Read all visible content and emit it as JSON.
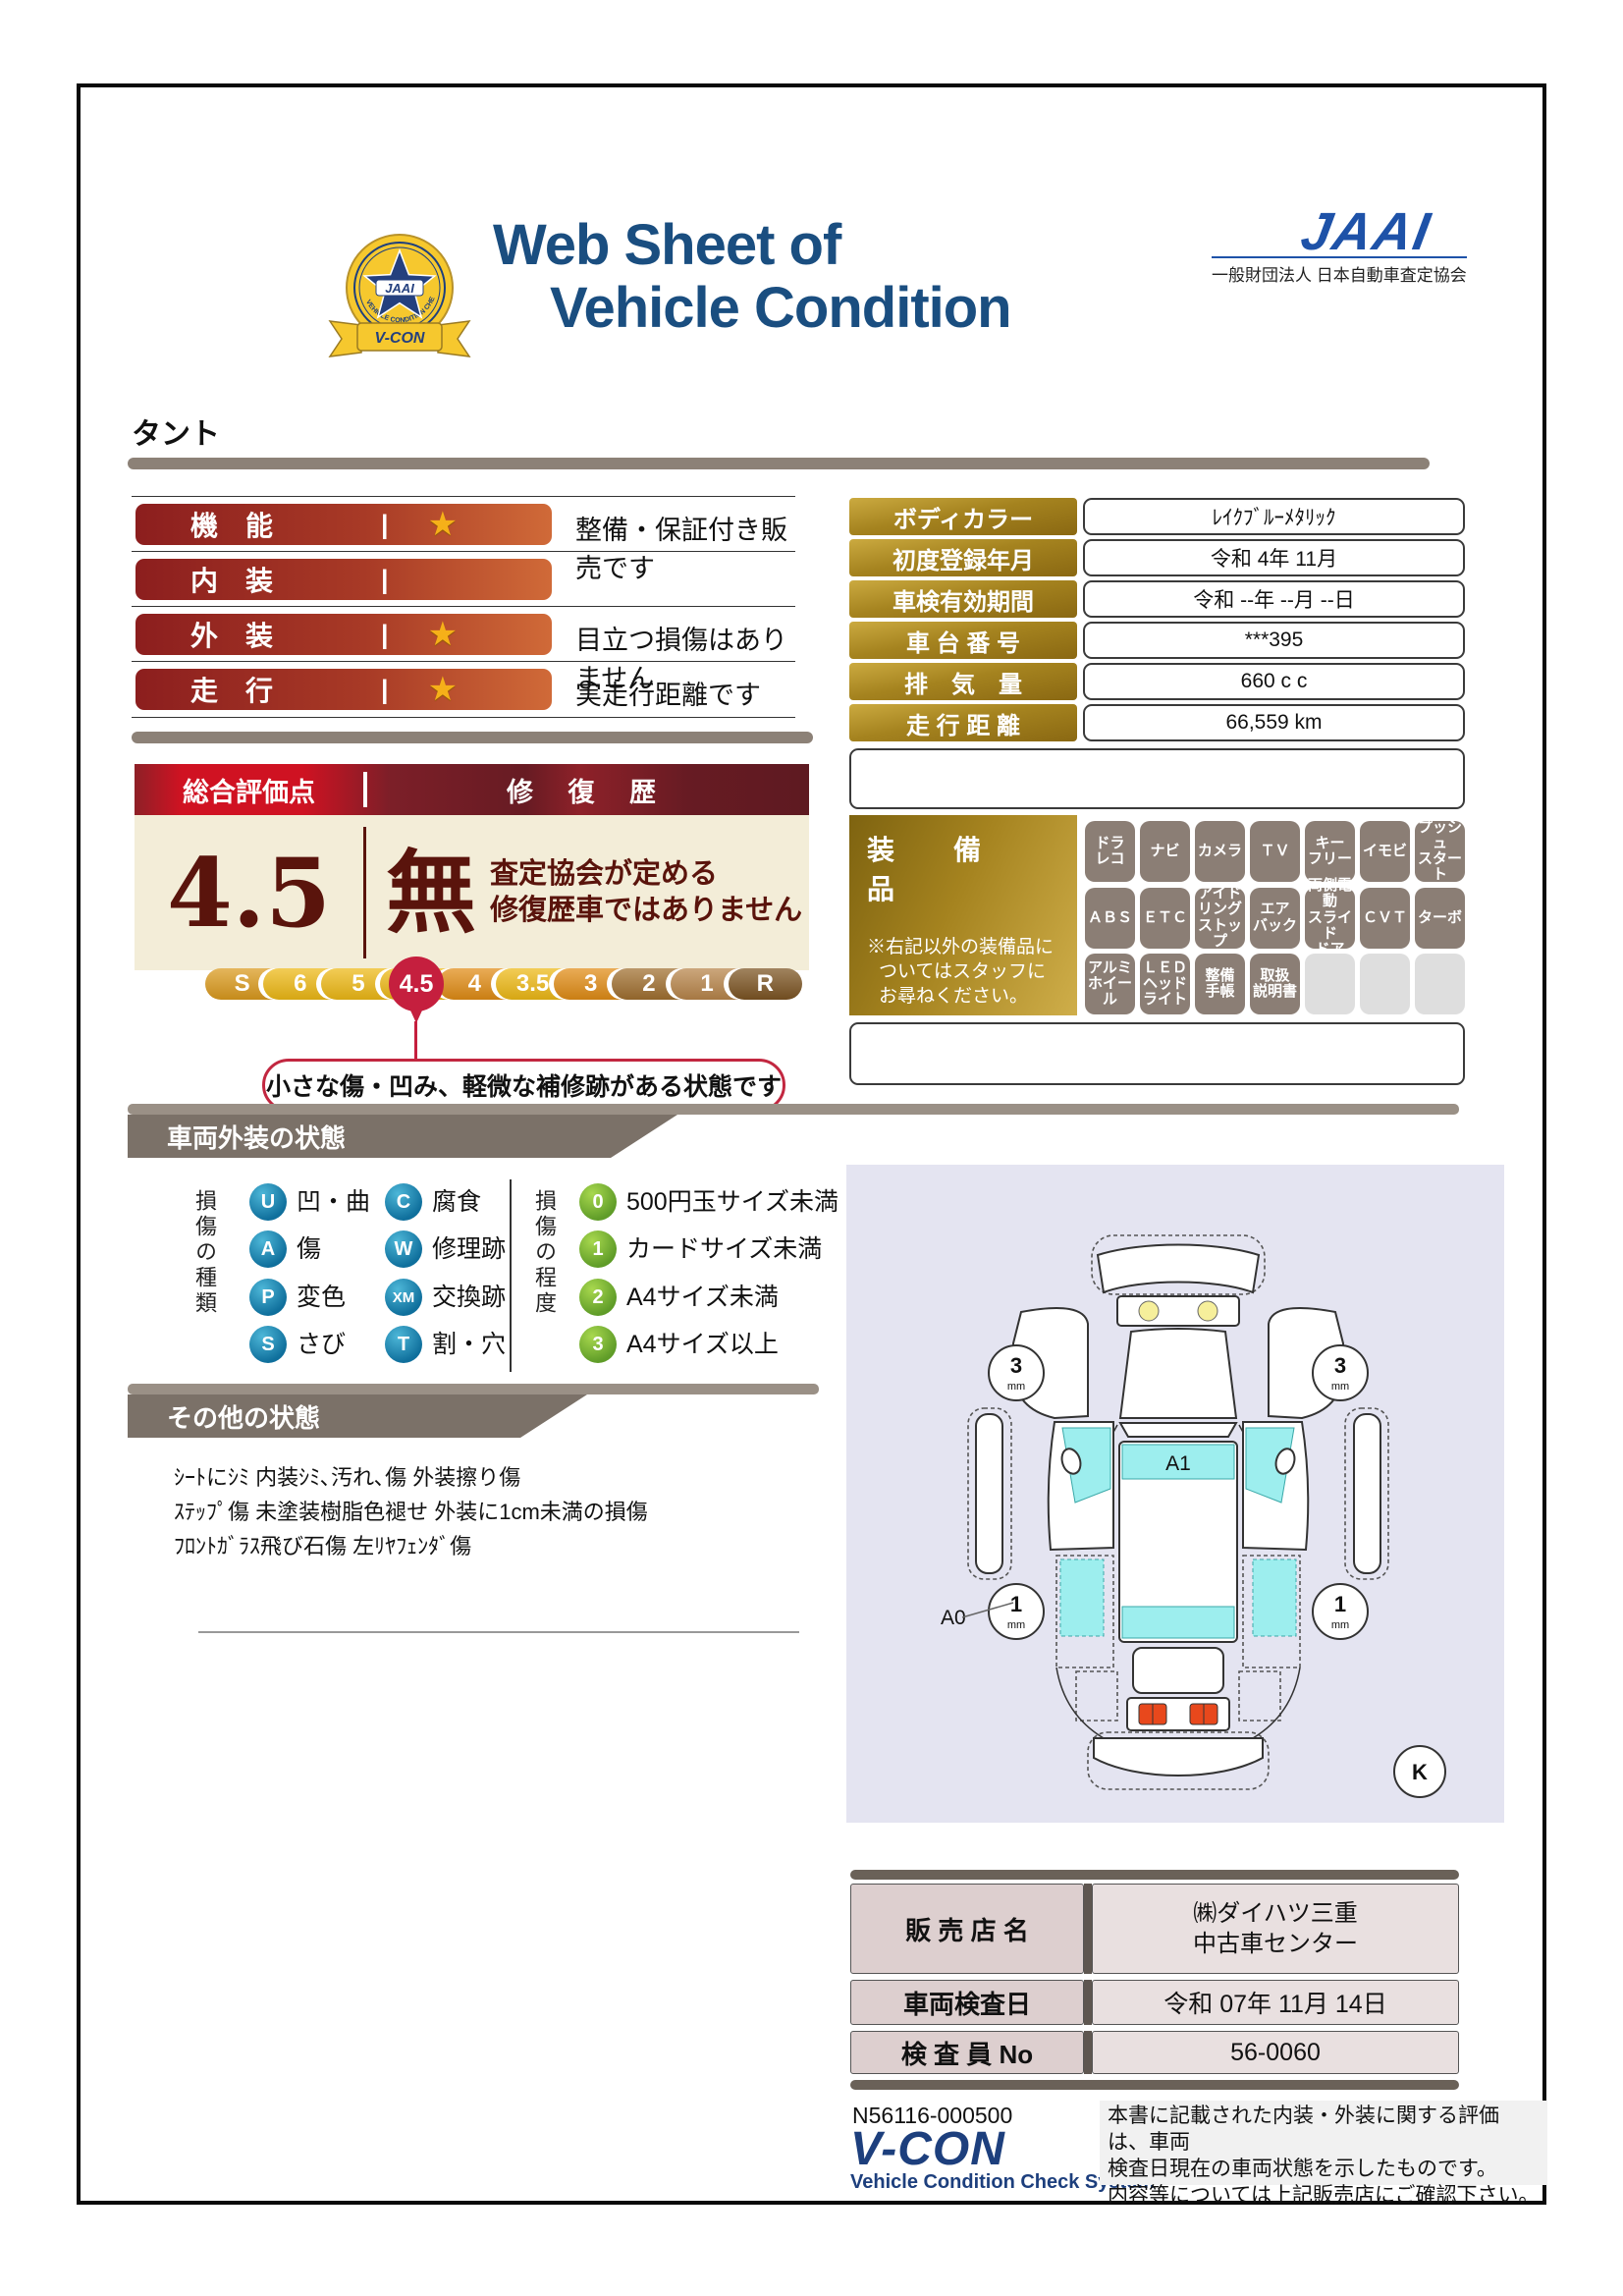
{
  "header": {
    "title_line1": "Web Sheet of",
    "title_line2": "Vehicle Condition",
    "jaai_wordmark": "JAAI",
    "jaai_org": "一般財団法人 日本自動車査定協会",
    "emblem": {
      "star_label": "JAAI",
      "arc_text": "VEHICLE CONDITION CHECK SYSTEM",
      "ribbon_label": "V-CON"
    }
  },
  "vehicle_name": "タント",
  "ratings": [
    {
      "label": "機　能",
      "star_char": "★",
      "comment": "整備・保証付き販売です"
    },
    {
      "label": "内　装",
      "star_char": "",
      "comment": ""
    },
    {
      "label": "外　装",
      "star_char": "★",
      "comment": "目立つ損傷はありません"
    },
    {
      "label": "走　行",
      "star_char": "★",
      "comment": "実走行距離です"
    }
  ],
  "evaluation": {
    "header_left": "総合評価点",
    "header_right": "修 復 歴",
    "score": "4.5",
    "repair_flag": "無",
    "repair_note_line1": "査定協会が定める",
    "repair_note_line2": "修復歴車ではありません",
    "scale": [
      {
        "label": "S",
        "color": "#db9a1d"
      },
      {
        "label": "6",
        "color": "#eeb915"
      },
      {
        "label": "5",
        "color": "#eeb915"
      },
      {
        "label": "4.5",
        "color": "#eeb915",
        "selected": true
      },
      {
        "label": "4",
        "color": "#e18c15"
      },
      {
        "label": "3.5",
        "color": "#eeb915"
      },
      {
        "label": "3",
        "color": "#e18c15"
      },
      {
        "label": "2",
        "color": "#a06f2f"
      },
      {
        "label": "1",
        "color": "#b8854a"
      },
      {
        "label": "R",
        "color": "#7c5422"
      }
    ],
    "callout": "小さな傷・凹み、軽微な補修跡がある状態です"
  },
  "info_table": [
    {
      "label": "ボディカラー",
      "value": "ﾚｲｸﾌﾞﾙｰﾒﾀﾘｯｸ"
    },
    {
      "label": "初度登録年月",
      "value": "令和 4年 11月"
    },
    {
      "label": "車検有効期間",
      "value": "令和 --年 --月 --日"
    },
    {
      "label": "車 台 番 号",
      "value": "***395"
    },
    {
      "label": "排　気　量",
      "value": "660 c c"
    },
    {
      "label": "走 行 距 離",
      "value": "66,559 km"
    }
  ],
  "equipment": {
    "title": "装　備　品",
    "note_line1": "※右記以外の装備品に",
    "note_line2": "ついてはスタッフに",
    "note_line3": "お尋ねください。",
    "badges": [
      {
        "label": "ドラ\nレコ"
      },
      {
        "label": "ナビ"
      },
      {
        "label": "カメラ"
      },
      {
        "label": "ＴＶ"
      },
      {
        "label": "キー\nフリー"
      },
      {
        "label": "イモビ"
      },
      {
        "label": "プッシュ\nスタート"
      },
      {
        "label": "ＡＢＳ"
      },
      {
        "label": "ＥＴＣ"
      },
      {
        "label": "アイド\nリング\nストップ"
      },
      {
        "label": "エア\nバック"
      },
      {
        "label": "両側電動\nスライド\nドア"
      },
      {
        "label": "ＣＶＴ"
      },
      {
        "label": "ターボ"
      },
      {
        "label": "アルミ\nホイール"
      },
      {
        "label": "ＬＥＤ\nヘッド\nライト"
      },
      {
        "label": "整備\n手帳"
      },
      {
        "label": "取扱\n説明書"
      },
      {
        "label": ""
      },
      {
        "label": ""
      },
      {
        "label": ""
      }
    ]
  },
  "exterior_section": {
    "title": "車両外装の状態",
    "type_header": "損傷の種類",
    "types": [
      {
        "code": "U",
        "label": "凹・曲"
      },
      {
        "code": "A",
        "label": "傷"
      },
      {
        "code": "P",
        "label": "変色"
      },
      {
        "code": "S",
        "label": "さび"
      },
      {
        "code": "C",
        "label": "腐食"
      },
      {
        "code": "W",
        "label": "修理跡"
      },
      {
        "code": "XM",
        "label": "交換跡"
      },
      {
        "code": "T",
        "label": "割・穴"
      }
    ],
    "degree_header": "損傷の程度",
    "degrees": [
      {
        "code": "0",
        "label": "500円玉サイズ未満"
      },
      {
        "code": "1",
        "label": "カードサイズ未満"
      },
      {
        "code": "2",
        "label": "A4サイズ未満"
      },
      {
        "code": "3",
        "label": "A4サイズ以上"
      }
    ]
  },
  "diagram": {
    "a1": "A1",
    "a0": "A0",
    "front_tread": "3",
    "rear_tread": "1",
    "unit": "mm",
    "k": "K"
  },
  "other_section": {
    "title": "その他の状態",
    "line1": "ｼｰﾄにｼﾐ 内装ｼﾐ､汚れ､傷 外装擦り傷",
    "line2": "ｽﾃｯﾌﾟ傷 未塗装樹脂色褪せ 外装に1cm未満の損傷",
    "line3": "ﾌﾛﾝﾄｶﾞﾗｽ飛び石傷 左ﾘﾔﾌｪﾝﾀﾞ傷"
  },
  "dealer_table": {
    "row1_label": "販 売 店 名",
    "row1_value_line1": "㈱ダイハツ三重",
    "row1_value_line2": "中古車センター",
    "row2_label": "車両検査日",
    "row2_value": "令和 07年 11月 14日",
    "row3_label": "検 査 員 No",
    "row3_value": "56-0060"
  },
  "footer": {
    "doc_number": "N56116-000500",
    "vcon_logo": "V-CON",
    "vcon_sub": "Vehicle Condition Check System",
    "disclaimer_line1": "本書に記載された内装・外装に関する評価は、車両",
    "disclaimer_line2": "検査日現在の車両状態を示したものです。",
    "disclaimer_line3": "内容等については上記販売店にご確認下さい。"
  },
  "colors": {
    "title_navy": "#1a4e80",
    "badge_red_dark": "#8c1e1e",
    "badge_red_light": "#d06a38",
    "gold_dark": "#8a6812",
    "gold_light": "#cbaa40",
    "eval_maroon": "#5a140c",
    "balloon_red": "#c51f3e",
    "section_taupe": "#7b7168",
    "panel_lavender": "#e4e4f1",
    "glass_cyan": "#9deeee"
  }
}
